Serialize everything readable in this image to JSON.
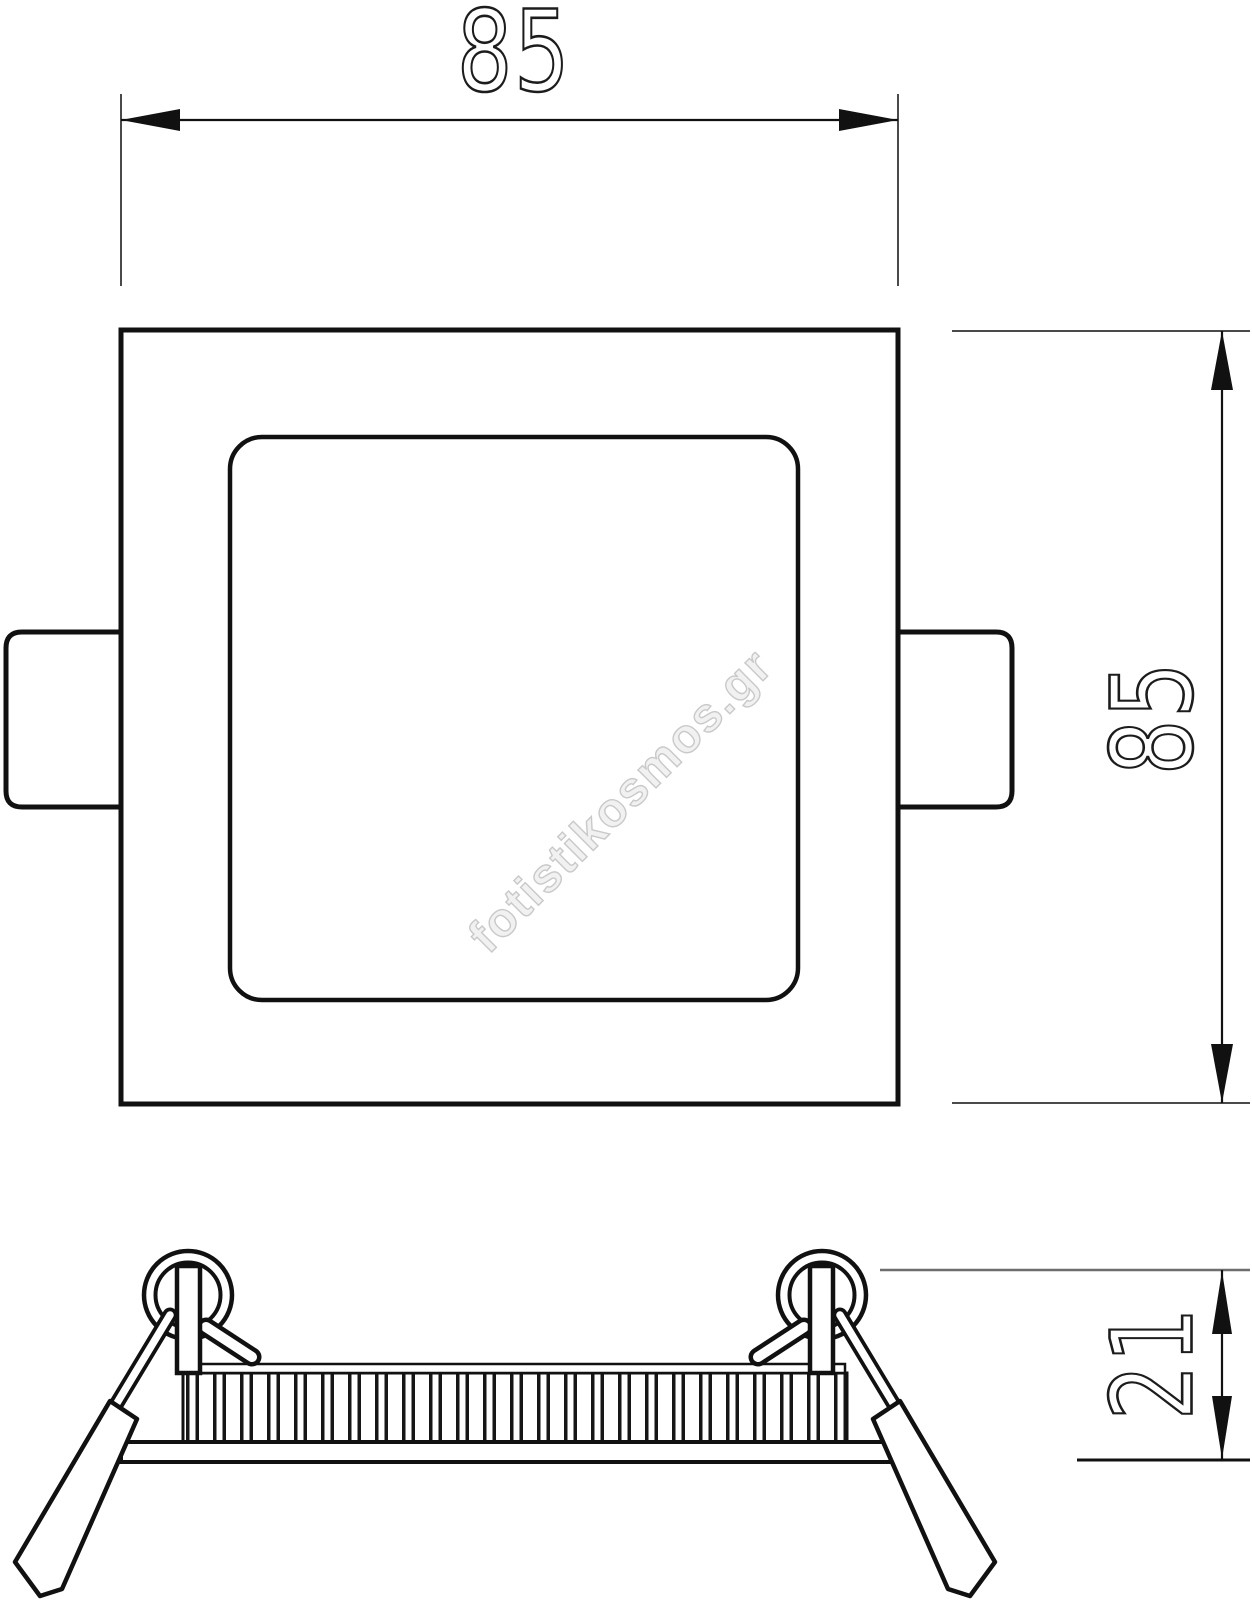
{
  "front_view": {
    "width_dim_label": "85",
    "height_dim_label": "85"
  },
  "side_view": {
    "height_dim_label": "21"
  },
  "watermark": {
    "text": "fotistikosmos.gr"
  },
  "colors": {
    "line": "#111111",
    "extension_line": "#4a4a4a",
    "watermark_fill": "#f1f1f1",
    "watermark_stroke": "#c9c9c9"
  }
}
